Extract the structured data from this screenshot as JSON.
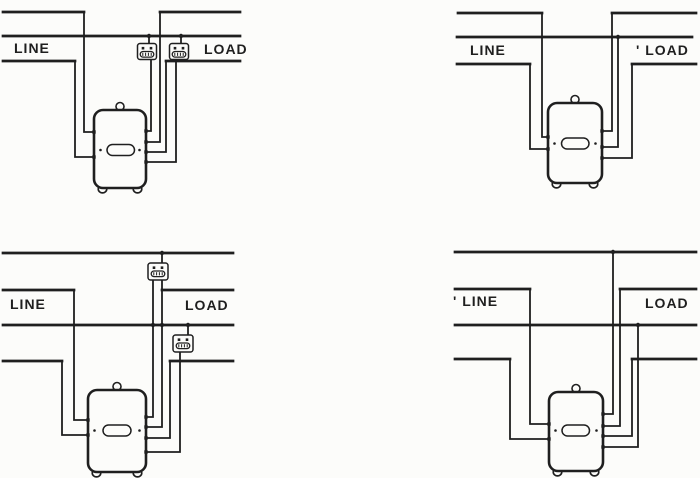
{
  "figure_title": "Meter wiring connection diagrams",
  "ink": "#1f1f1f",
  "paper": "#fcfcfa",
  "canvas": {
    "width": 700,
    "height": 478
  },
  "panels": [
    {
      "id": "top-left",
      "labels": [
        {
          "name": "line-label",
          "text": "LINE",
          "x": 14,
          "y": 40
        },
        {
          "name": "load-label",
          "text": "LOAD",
          "x": 204,
          "y": 41
        }
      ],
      "buses": [
        [
          [
            3,
            12
          ],
          [
            84,
            12
          ]
        ],
        [
          [
            160,
            12
          ],
          [
            240,
            12
          ]
        ],
        [
          [
            3,
            36
          ],
          [
            240,
            36
          ]
        ],
        [
          [
            3,
            61
          ],
          [
            75,
            61
          ]
        ],
        [
          [
            166,
            61
          ],
          [
            240,
            61
          ]
        ]
      ],
      "wires": [
        [
          [
            84,
            12
          ],
          [
            84,
            132
          ],
          [
            94,
            132
          ]
        ],
        [
          [
            75,
            61
          ],
          [
            75,
            157
          ],
          [
            94,
            157
          ]
        ],
        [
          [
            151,
            59
          ],
          [
            151,
            131
          ],
          [
            146,
            131
          ]
        ],
        [
          [
            160,
            12
          ],
          [
            160,
            142
          ],
          [
            146,
            142
          ]
        ],
        [
          [
            166,
            61
          ],
          [
            166,
            152
          ],
          [
            146,
            152
          ]
        ],
        [
          [
            176,
            59
          ],
          [
            176,
            162
          ],
          [
            146,
            162
          ]
        ],
        [
          [
            149,
            36
          ],
          [
            149,
            44
          ]
        ],
        [
          [
            181,
            36
          ],
          [
            181,
            44
          ]
        ]
      ],
      "dots": [
        [
          149,
          36
        ],
        [
          181,
          36
        ]
      ],
      "fuses": [
        {
          "x": 137.5,
          "y": 43.5,
          "w": 19,
          "h": 16
        },
        {
          "x": 169.5,
          "y": 43.5,
          "w": 19,
          "h": 16
        }
      ],
      "meter": {
        "x": 94,
        "y": 110,
        "w": 52,
        "h": 78,
        "oval": {
          "x": 107,
          "y": 144.5,
          "w": 27.5,
          "h": 11
        },
        "terminals_left": [
          132,
          157
        ],
        "terminals_right": [
          131,
          142,
          152,
          162
        ]
      }
    },
    {
      "id": "top-right",
      "labels": [
        {
          "name": "line-label",
          "text": "LINE",
          "x": 470,
          "y": 42
        },
        {
          "name": "load-label",
          "text": "' LOAD",
          "x": 636,
          "y": 42
        }
      ],
      "buses": [
        [
          [
            458,
            13
          ],
          [
            542,
            13
          ]
        ],
        [
          [
            612,
            13
          ],
          [
            696,
            13
          ]
        ],
        [
          [
            457,
            37
          ],
          [
            692,
            37
          ]
        ],
        [
          [
            457,
            64
          ],
          [
            530,
            64
          ]
        ],
        [
          [
            632,
            64
          ],
          [
            696,
            64
          ]
        ]
      ],
      "wires": [
        [
          [
            542,
            13
          ],
          [
            542,
            137
          ],
          [
            548,
            137
          ]
        ],
        [
          [
            530,
            64
          ],
          [
            530,
            149
          ],
          [
            548,
            149
          ]
        ],
        [
          [
            612,
            13
          ],
          [
            612,
            131
          ],
          [
            602,
            131
          ]
        ],
        [
          [
            618,
            37
          ],
          [
            618,
            147
          ],
          [
            602,
            147
          ]
        ],
        [
          [
            632,
            64
          ],
          [
            632,
            158
          ],
          [
            602,
            158
          ]
        ]
      ],
      "dots": [
        [
          618,
          37
        ]
      ],
      "fuses": [],
      "meter": {
        "x": 548,
        "y": 103,
        "w": 54,
        "h": 80,
        "oval": {
          "x": 561.5,
          "y": 138,
          "w": 27.5,
          "h": 11
        },
        "terminals_left": [
          137,
          149
        ],
        "terminals_right": [
          131,
          147,
          158
        ]
      }
    },
    {
      "id": "bottom-left",
      "labels": [
        {
          "name": "line-label",
          "text": "LINE",
          "x": 10,
          "y": 296
        },
        {
          "name": "load-label",
          "text": "LOAD",
          "x": 185,
          "y": 297
        }
      ],
      "buses": [
        [
          [
            3,
            253
          ],
          [
            233,
            253
          ]
        ],
        [
          [
            3,
            290
          ],
          [
            74,
            290
          ]
        ],
        [
          [
            162,
            290
          ],
          [
            233,
            290
          ]
        ],
        [
          [
            3,
            325
          ],
          [
            233,
            325
          ]
        ],
        [
          [
            3,
            361
          ],
          [
            62,
            361
          ]
        ],
        [
          [
            170,
            361
          ],
          [
            233,
            361
          ]
        ]
      ],
      "wires": [
        [
          [
            74,
            290
          ],
          [
            74,
            420
          ],
          [
            88,
            420
          ]
        ],
        [
          [
            62,
            361
          ],
          [
            62,
            435
          ],
          [
            88,
            435
          ]
        ],
        [
          [
            153,
            281
          ],
          [
            153,
            417
          ],
          [
            146,
            417
          ]
        ],
        [
          [
            162,
            281
          ],
          [
            162,
            427
          ],
          [
            146,
            427
          ]
        ],
        [
          [
            170,
            361
          ],
          [
            170,
            438
          ],
          [
            146,
            438
          ]
        ],
        [
          [
            180,
            353
          ],
          [
            180,
            452
          ],
          [
            146,
            452
          ]
        ],
        [
          [
            162,
            253
          ],
          [
            162,
            264
          ]
        ],
        [
          [
            188,
            325
          ],
          [
            188,
            336
          ]
        ]
      ],
      "dots": [
        [
          162,
          253
        ],
        [
          188,
          325
        ],
        [
          153,
          325
        ],
        [
          162,
          325
        ]
      ],
      "fuses": [
        {
          "x": 148,
          "y": 263,
          "w": 20,
          "h": 17
        },
        {
          "x": 173,
          "y": 335,
          "w": 20,
          "h": 17
        }
      ],
      "meter": {
        "x": 88,
        "y": 390,
        "w": 58,
        "h": 82,
        "oval": {
          "x": 103,
          "y": 425,
          "w": 28,
          "h": 11
        },
        "terminals_left": [
          420,
          435
        ],
        "terminals_right": [
          417,
          427,
          438,
          452
        ]
      }
    },
    {
      "id": "bottom-right",
      "labels": [
        {
          "name": "line-label",
          "text": "' LINE",
          "x": 453,
          "y": 293
        },
        {
          "name": "load-label",
          "text": "LOAD",
          "x": 645,
          "y": 295
        }
      ],
      "buses": [
        [
          [
            455,
            252
          ],
          [
            696,
            252
          ]
        ],
        [
          [
            455,
            289
          ],
          [
            530,
            289
          ]
        ],
        [
          [
            620,
            289
          ],
          [
            696,
            289
          ]
        ],
        [
          [
            455,
            325
          ],
          [
            696,
            325
          ]
        ],
        [
          [
            455,
            359
          ],
          [
            510,
            359
          ]
        ],
        [
          [
            632,
            359
          ],
          [
            696,
            359
          ]
        ]
      ],
      "wires": [
        [
          [
            530,
            289
          ],
          [
            530,
            424
          ],
          [
            549,
            424
          ]
        ],
        [
          [
            510,
            359
          ],
          [
            510,
            439
          ],
          [
            549,
            439
          ]
        ],
        [
          [
            613,
            252
          ],
          [
            613,
            414
          ],
          [
            603,
            414
          ]
        ],
        [
          [
            620,
            289
          ],
          [
            620,
            426
          ],
          [
            603,
            426
          ]
        ],
        [
          [
            632,
            359
          ],
          [
            632,
            436
          ],
          [
            603,
            436
          ]
        ],
        [
          [
            638,
            325
          ],
          [
            638,
            447
          ],
          [
            603,
            447
          ]
        ]
      ],
      "dots": [
        [
          613,
          252
        ],
        [
          638,
          325
        ]
      ],
      "fuses": [],
      "meter": {
        "x": 549,
        "y": 392,
        "w": 54,
        "h": 79,
        "oval": {
          "x": 562,
          "y": 425,
          "w": 27.5,
          "h": 11
        },
        "terminals_left": [
          424,
          439
        ],
        "terminals_right": [
          414,
          426,
          436,
          447
        ]
      }
    }
  ]
}
